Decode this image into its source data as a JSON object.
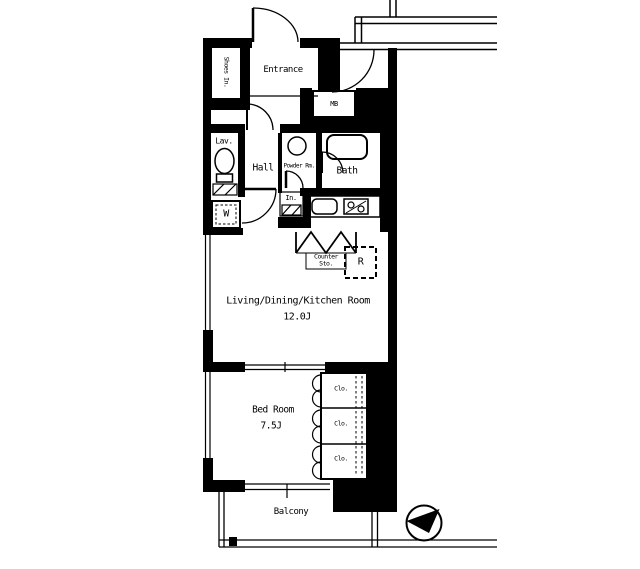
{
  "colors": {
    "line": "#000000",
    "background": "#ffffff"
  },
  "floorplan": {
    "entrance": "Entrance",
    "shoes_closet": "Shoes In.",
    "meter_box": "MB",
    "lavatory": "Lav.",
    "hall": "Hall",
    "powder_room": "Powder Rm.",
    "bath": "Bath",
    "storage": "In.",
    "washer": "W",
    "counter_storage": "Counter Sto.",
    "refrigerator": "R",
    "living_dining_kitchen": {
      "name": "Living/Dining/Kitchen Room",
      "size": "12.0J"
    },
    "bedroom": {
      "name": "Bed Room",
      "size": "7.5J"
    },
    "closets": [
      {
        "label": "Clo."
      },
      {
        "label": "Clo."
      },
      {
        "label": "Clo."
      }
    ],
    "balcony": "Balcony",
    "icons": {
      "compass": "north-arrow-icon",
      "toilet": "toilet-icon",
      "bathtub": "bathtub-icon",
      "kitchen_sink": "kitchen-sink-icon",
      "stove": "stove-icon",
      "washbasin": "washbasin-icon",
      "washing_machine": "washing-machine-icon"
    }
  }
}
